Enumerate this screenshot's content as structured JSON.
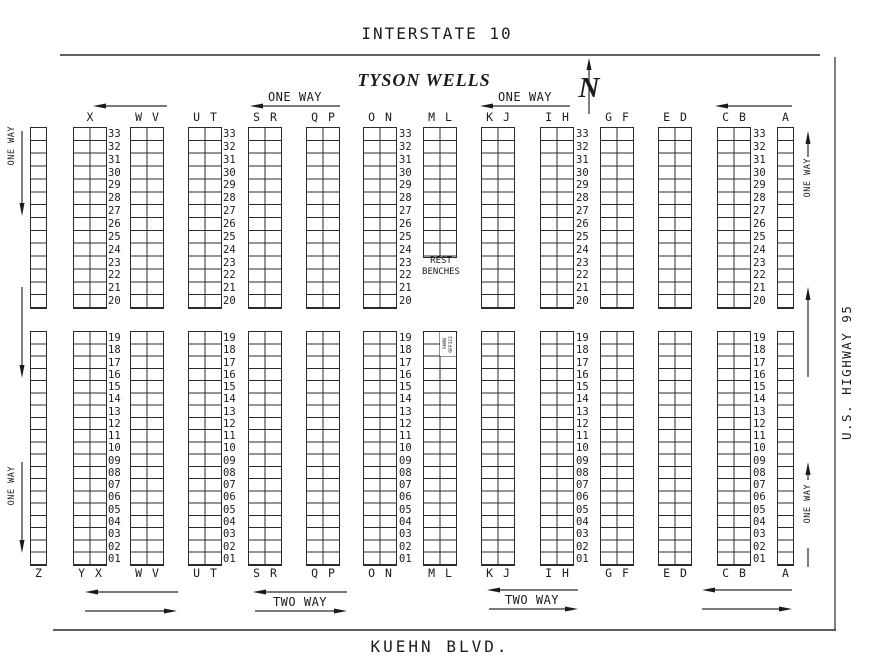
{
  "title": "TYSON WELLS",
  "roads": {
    "top": "INTERSTATE 10",
    "bottom": "KUEHN BLVD.",
    "right": "U.S. HIGHWAY 95"
  },
  "compass": {
    "label": "N"
  },
  "direction_labels": {
    "one_way": "ONE WAY",
    "two_way": "TWO WAY"
  },
  "annotations": {
    "rest_benches": [
      "REST",
      "BENCHES"
    ],
    "show_office": [
      "SHOW",
      "OFFICE"
    ]
  },
  "row_numbers": {
    "top_block": [
      "33",
      "32",
      "31",
      "30",
      "29",
      "28",
      "27",
      "26",
      "25",
      "24",
      "23",
      "22",
      "21",
      "20"
    ],
    "bottom_block": [
      "19",
      "18",
      "17",
      "16",
      "15",
      "14",
      "13",
      "12",
      "11",
      "10",
      "09",
      "08",
      "07",
      "06",
      "05",
      "04",
      "03",
      "02",
      "01"
    ]
  },
  "column_groups": [
    {
      "top_label": "",
      "bottom_label": "Z",
      "x": 30,
      "cols": 1
    },
    {
      "top_label": "X",
      "bottom_label": "Y X",
      "x": 73,
      "cols": 2
    },
    {
      "top_label": "W V",
      "bottom_label": "W V",
      "x": 130,
      "cols": 2
    },
    {
      "top_label": "U T",
      "bottom_label": "U T",
      "x": 188,
      "cols": 2
    },
    {
      "top_label": "S R",
      "bottom_label": "S R",
      "x": 248,
      "cols": 2
    },
    {
      "top_label": "Q P",
      "bottom_label": "Q P",
      "x": 306,
      "cols": 2
    },
    {
      "top_label": "O N",
      "bottom_label": "O N",
      "x": 363,
      "cols": 2
    },
    {
      "top_label": "M L",
      "bottom_label": "M L",
      "x": 423,
      "cols": 2,
      "top_block_rows": 10,
      "has_rest_benches": true,
      "has_show_office": true
    },
    {
      "top_label": "K J",
      "bottom_label": "K J",
      "x": 481,
      "cols": 2
    },
    {
      "top_label": "I H",
      "bottom_label": "I H",
      "x": 540,
      "cols": 2
    },
    {
      "top_label": "G F",
      "bottom_label": "G F",
      "x": 600,
      "cols": 2
    },
    {
      "top_label": "E D",
      "bottom_label": "E D",
      "x": 658,
      "cols": 2
    },
    {
      "top_label": "C B",
      "bottom_label": "C B",
      "x": 717,
      "cols": 2
    },
    {
      "top_label": "A",
      "bottom_label": "A",
      "x": 777,
      "cols": 1
    }
  ],
  "number_column_xs": [
    108,
    223,
    399,
    576,
    753
  ],
  "geometry": {
    "cell_w": 17,
    "top_label_y": 111,
    "bottom_label_y": 567,
    "top_block": {
      "top": 127,
      "rows": 14,
      "row_h": 12.857
    },
    "bottom_block": {
      "top": 331,
      "rows": 19,
      "row_h": 12.263
    }
  }
}
